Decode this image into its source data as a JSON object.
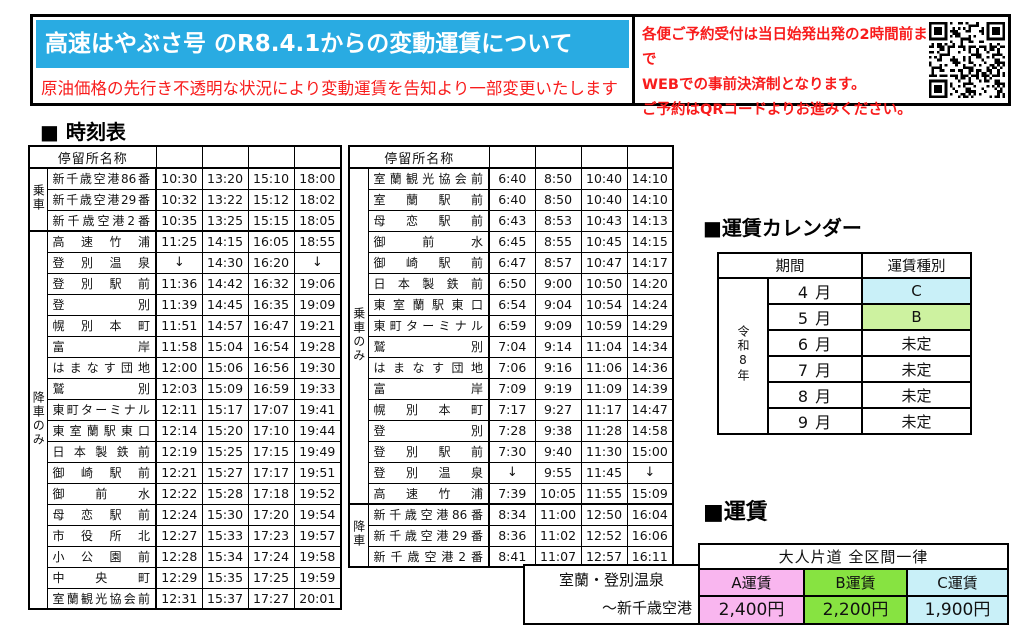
{
  "banner": {
    "title": "高速はやぶさ号 のR8.4.1からの変動運賃について",
    "subtitle": "原油価格の先行き不透明な状況により変動運賃を告知より一部変更いたします",
    "notice_lines": [
      "各便ご予約受付は当日始発出発の2時間前まで",
      "WEBでの事前決済制となります。",
      "ご予約はQRコードよりお進みください。"
    ],
    "accent_blue": "#29abe2",
    "accent_red": "#f81c1c"
  },
  "timetable_heading": "■ 時刻表",
  "timetables": [
    {
      "name_header": "停留所名称",
      "time_cols": 4,
      "groups": [
        {
          "label": "乗車",
          "rows": [
            {
              "name": "新千歳空港86番",
              "times": [
                "10:30",
                "13:20",
                "15:10",
                "18:00"
              ]
            },
            {
              "name": "新千歳空港29番",
              "times": [
                "10:32",
                "13:22",
                "15:12",
                "18:02"
              ]
            },
            {
              "name": "新千歳空港2番",
              "times": [
                "10:35",
                "13:25",
                "15:15",
                "18:05"
              ]
            }
          ]
        },
        {
          "label": "降車のみ",
          "rows": [
            {
              "name": "高速竹浦",
              "times": [
                "11:25",
                "14:15",
                "16:05",
                "18:55"
              ]
            },
            {
              "name": "登別温泉",
              "times": [
                "↓",
                "14:30",
                "16:20",
                "↓"
              ]
            },
            {
              "name": "登別駅前",
              "times": [
                "11:36",
                "14:42",
                "16:32",
                "19:06"
              ]
            },
            {
              "name": "登別",
              "times": [
                "11:39",
                "14:45",
                "16:35",
                "19:09"
              ]
            },
            {
              "name": "幌別本町",
              "times": [
                "11:51",
                "14:57",
                "16:47",
                "19:21"
              ]
            },
            {
              "name": "富岸",
              "times": [
                "11:58",
                "15:04",
                "16:54",
                "19:28"
              ]
            },
            {
              "name": "はまなす団地",
              "times": [
                "12:00",
                "15:06",
                "16:56",
                "19:30"
              ]
            },
            {
              "name": "鷲別",
              "times": [
                "12:03",
                "15:09",
                "16:59",
                "19:33"
              ]
            },
            {
              "name": "東町ターミナル",
              "times": [
                "12:11",
                "15:17",
                "17:07",
                "19:41"
              ]
            },
            {
              "name": "東室蘭駅東口",
              "times": [
                "12:14",
                "15:20",
                "17:10",
                "19:44"
              ]
            },
            {
              "name": "日本製鉄前",
              "times": [
                "12:19",
                "15:25",
                "17:15",
                "19:49"
              ]
            },
            {
              "name": "御崎駅前",
              "times": [
                "12:21",
                "15:27",
                "17:17",
                "19:51"
              ]
            },
            {
              "name": "御前水",
              "times": [
                "12:22",
                "15:28",
                "17:18",
                "19:52"
              ]
            },
            {
              "name": "母恋駅前",
              "times": [
                "12:24",
                "15:30",
                "17:20",
                "19:54"
              ]
            },
            {
              "name": "市役所北",
              "times": [
                "12:27",
                "15:33",
                "17:23",
                "19:57"
              ]
            },
            {
              "name": "小公園前",
              "times": [
                "12:28",
                "15:34",
                "17:24",
                "19:58"
              ]
            },
            {
              "name": "中央町",
              "times": [
                "12:29",
                "15:35",
                "17:25",
                "19:59"
              ]
            },
            {
              "name": "室蘭観光協会前",
              "times": [
                "12:31",
                "15:37",
                "17:27",
                "20:01"
              ]
            }
          ]
        }
      ]
    },
    {
      "name_header": "停留所名称",
      "time_cols": 4,
      "groups": [
        {
          "label": "乗車のみ",
          "rows": [
            {
              "name": "室蘭観光協会前",
              "times": [
                "6:40",
                "8:50",
                "10:40",
                "14:10"
              ]
            },
            {
              "name": "室蘭駅前",
              "times": [
                "6:40",
                "8:50",
                "10:40",
                "14:10"
              ]
            },
            {
              "name": "母恋駅前",
              "times": [
                "6:43",
                "8:53",
                "10:43",
                "14:13"
              ]
            },
            {
              "name": "御前水",
              "times": [
                "6:45",
                "8:55",
                "10:45",
                "14:15"
              ]
            },
            {
              "name": "御崎駅前",
              "times": [
                "6:47",
                "8:57",
                "10:47",
                "14:17"
              ]
            },
            {
              "name": "日本製鉄前",
              "times": [
                "6:50",
                "9:00",
                "10:50",
                "14:20"
              ]
            },
            {
              "name": "東室蘭駅東口",
              "times": [
                "6:54",
                "9:04",
                "10:54",
                "14:24"
              ]
            },
            {
              "name": "東町ターミナル",
              "times": [
                "6:59",
                "9:09",
                "10:59",
                "14:29"
              ]
            },
            {
              "name": "鷲別",
              "times": [
                "7:04",
                "9:14",
                "11:04",
                "14:34"
              ]
            },
            {
              "name": "はまなす団地",
              "times": [
                "7:06",
                "9:16",
                "11:06",
                "14:36"
              ]
            },
            {
              "name": "富岸",
              "times": [
                "7:09",
                "9:19",
                "11:09",
                "14:39"
              ]
            },
            {
              "name": "幌別本町",
              "times": [
                "7:17",
                "9:27",
                "11:17",
                "14:47"
              ]
            },
            {
              "name": "登別",
              "times": [
                "7:28",
                "9:38",
                "11:28",
                "14:58"
              ]
            },
            {
              "name": "登別駅前",
              "times": [
                "7:30",
                "9:40",
                "11:30",
                "15:00"
              ]
            },
            {
              "name": "登別温泉",
              "times": [
                "↓",
                "9:55",
                "11:45",
                "↓"
              ]
            },
            {
              "name": "高速竹浦",
              "times": [
                "7:39",
                "10:05",
                "11:55",
                "15:09"
              ]
            }
          ]
        },
        {
          "label": "降車",
          "rows": [
            {
              "name": "新千歳空港86番",
              "times": [
                "8:34",
                "11:00",
                "12:50",
                "16:04"
              ]
            },
            {
              "name": "新千歳空港29番",
              "times": [
                "8:36",
                "11:02",
                "12:52",
                "16:06"
              ]
            },
            {
              "name": "新千歳空港2番",
              "times": [
                "8:41",
                "11:07",
                "12:57",
                "16:11"
              ]
            }
          ]
        }
      ]
    }
  ],
  "calendar": {
    "heading": "■運賃カレンダー",
    "period_header": "期間",
    "type_header": "運賃種別",
    "year_label": "令和8年",
    "months": [
      {
        "month": "4 月",
        "type": "C",
        "bg": "#c9f0f8"
      },
      {
        "month": "5 月",
        "type": "B",
        "bg": "#cdf2a0"
      },
      {
        "month": "6 月",
        "type": "未定",
        "bg": "#ffffff"
      },
      {
        "month": "7 月",
        "type": "未定",
        "bg": "#ffffff"
      },
      {
        "month": "8 月",
        "type": "未定",
        "bg": "#ffffff"
      },
      {
        "month": "9 月",
        "type": "未定",
        "bg": "#ffffff"
      }
    ]
  },
  "fare": {
    "heading": "■運賃",
    "span_header": "大人片道 全区間一律",
    "route_line1": "室蘭・登別温泉",
    "route_line2": "〜新千歳空港",
    "types": [
      {
        "label": "A運賃",
        "price": "2,400円",
        "bg": "#f9b6ef"
      },
      {
        "label": "B運賃",
        "price": "2,200円",
        "bg": "#87e341"
      },
      {
        "label": "C運賃",
        "price": "1,900円",
        "bg": "#c9f0f8"
      }
    ]
  }
}
